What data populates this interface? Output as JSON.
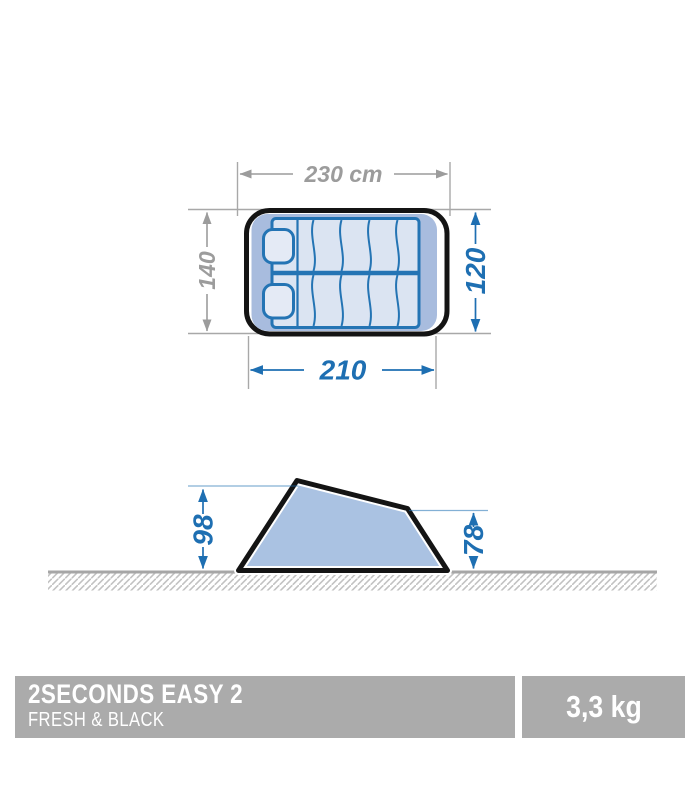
{
  "colors": {
    "dimension_blue": "#1e6fb2",
    "dimension_gray": "#9c9c9c",
    "line_gray": "#a8a8a8",
    "outline_black": "#141414",
    "floor_fill": "#a8bcde",
    "mat_fill": "#dbe4f2",
    "mat_stroke": "#2474b4",
    "side_fill": "#aac2e2",
    "banner_bg": "#ababab",
    "banner_text": "#ffffff"
  },
  "top_view": {
    "total_width_label": "230 cm",
    "floor_length_label": "210",
    "depth_label": "140",
    "inner_width_label": "120"
  },
  "side_view": {
    "front_height_label": "98",
    "rear_height_label": "78"
  },
  "banner": {
    "product_name": "2SECONDS EASY 2",
    "product_variant": "FRESH & BLACK",
    "weight": "3,3 kg"
  }
}
